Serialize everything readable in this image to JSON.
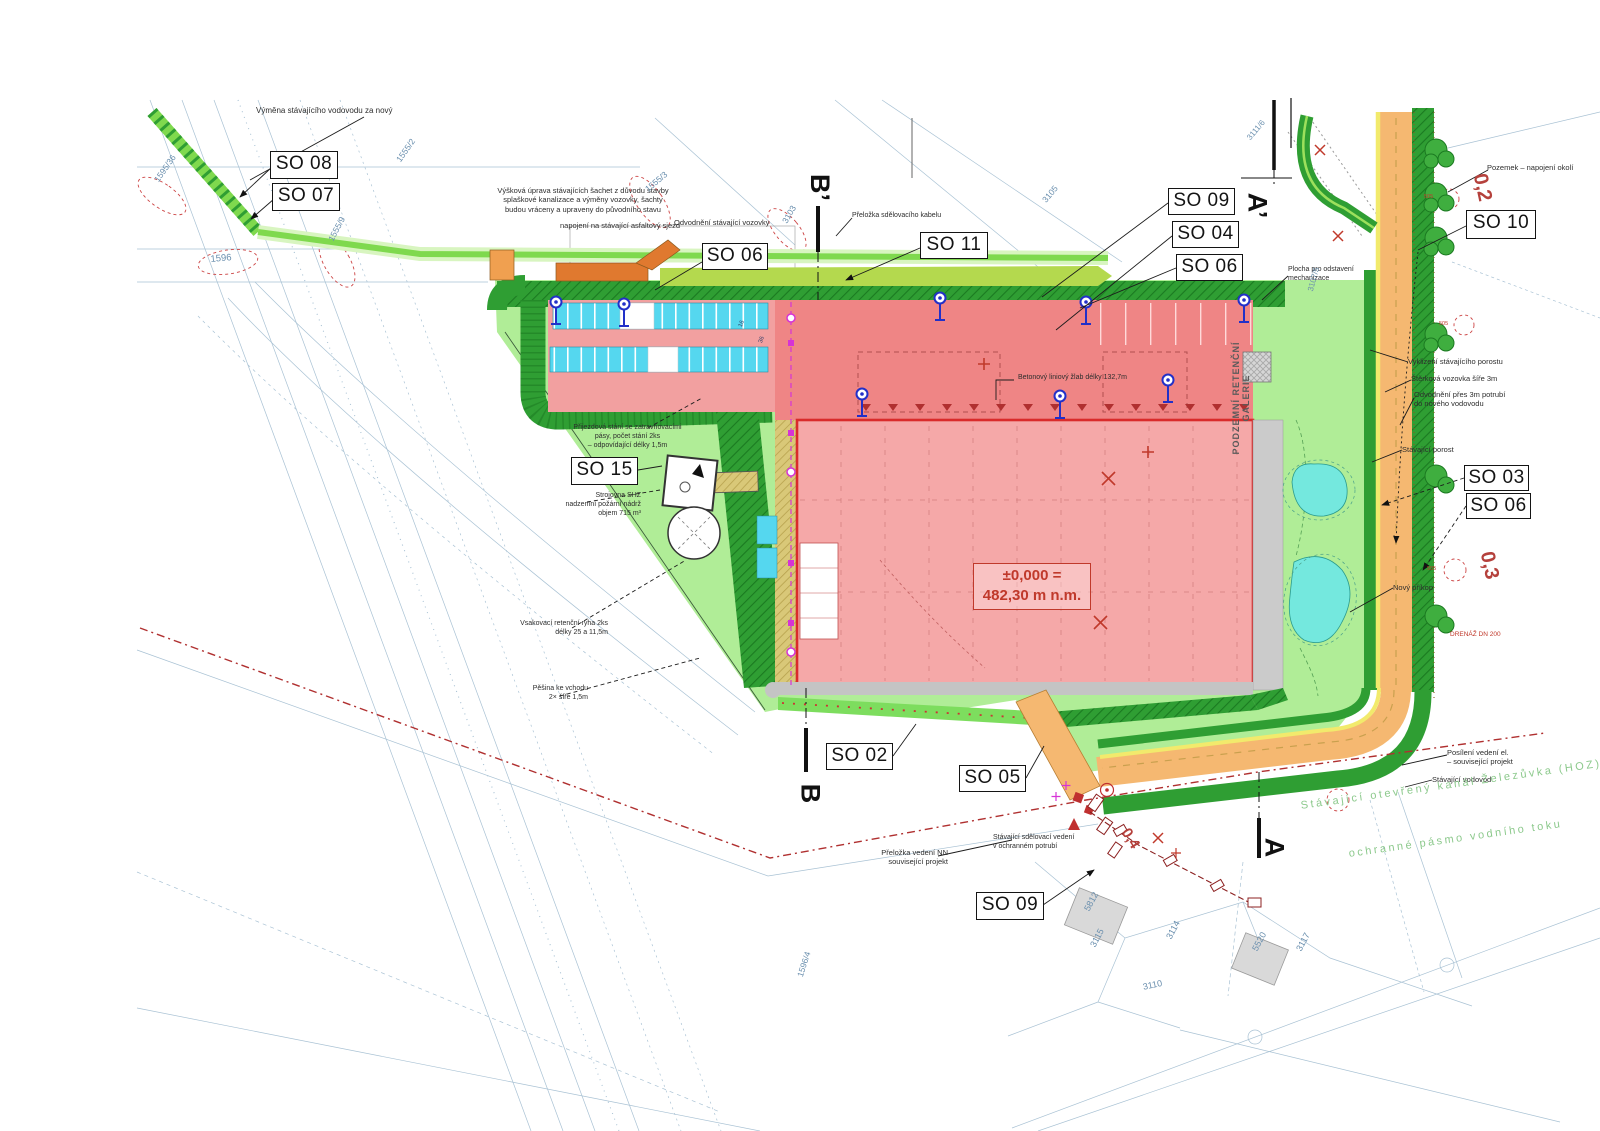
{
  "elevation": {
    "line1": "±0,000 =",
    "line2": "482,30 m n.m."
  },
  "building_text": "PODZEMNÍ RETENČNÍ GALERIE",
  "colors": {
    "lawn": "#b0ed97",
    "green_belt": "#2f9e33",
    "green_hatch": "#1b7a21",
    "road_orange": "#f5b871",
    "edge_yellow": "#f2ea6c",
    "parking_cyan": "#55d7ef",
    "pond_cyan": "#74e8de",
    "building_pink": "#f5a8a8",
    "dock_pink": "#ef8585",
    "outline_red": "#d92b2b",
    "utility_red": "#b03030",
    "magenta": "#d633d6",
    "hydrant_blue": "#2230c8",
    "parcel_blue": "#6a8fae"
  },
  "so_labels": [
    {
      "id": "so-08",
      "text": "SO 08",
      "x": 270,
      "y": 151,
      "w": 68,
      "h": 28
    },
    {
      "id": "so-07",
      "text": "SO 07",
      "x": 272,
      "y": 183,
      "w": 68,
      "h": 28
    },
    {
      "id": "so-06a",
      "text": "SO 06",
      "x": 702,
      "y": 243,
      "w": 66,
      "h": 27
    },
    {
      "id": "so-11",
      "text": "SO 11",
      "x": 920,
      "y": 232,
      "w": 68,
      "h": 27
    },
    {
      "id": "so-09a",
      "text": "SO 09",
      "x": 1168,
      "y": 188,
      "w": 67,
      "h": 27
    },
    {
      "id": "so-04",
      "text": "SO 04",
      "x": 1172,
      "y": 221,
      "w": 67,
      "h": 27
    },
    {
      "id": "so-06b",
      "text": "SO 06",
      "x": 1176,
      "y": 254,
      "w": 67,
      "h": 27
    },
    {
      "id": "so-10",
      "text": "SO 10",
      "x": 1466,
      "y": 210,
      "w": 70,
      "h": 29
    },
    {
      "id": "so-03",
      "text": "SO 03",
      "x": 1464,
      "y": 465,
      "w": 65,
      "h": 26
    },
    {
      "id": "so-06c",
      "text": "SO 06",
      "x": 1466,
      "y": 493,
      "w": 65,
      "h": 26
    },
    {
      "id": "so-15",
      "text": "SO 15",
      "x": 571,
      "y": 457,
      "w": 67,
      "h": 28
    },
    {
      "id": "so-02",
      "text": "SO 02",
      "x": 826,
      "y": 743,
      "w": 67,
      "h": 27
    },
    {
      "id": "so-05",
      "text": "SO 05",
      "x": 959,
      "y": 765,
      "w": 67,
      "h": 27
    },
    {
      "id": "so-09b",
      "text": "SO 09",
      "x": 976,
      "y": 892,
      "w": 68,
      "h": 28
    }
  ],
  "section_markers": [
    {
      "id": "b-prime",
      "text": "B’",
      "x": 806,
      "y": 172
    },
    {
      "id": "b",
      "text": "B",
      "x": 800,
      "y": 778
    },
    {
      "id": "a-prime",
      "text": "A’",
      "x": 1244,
      "y": 190
    },
    {
      "id": "a",
      "text": "A",
      "x": 1264,
      "y": 832
    }
  ],
  "red_notes": [
    {
      "text": "0,2",
      "x": 1468,
      "y": 176,
      "rot": 78,
      "size": 20
    },
    {
      "text": "0,3",
      "x": 1475,
      "y": 554,
      "rot": 78,
      "size": 20
    },
    {
      "text": "0,4",
      "x": 1120,
      "y": 830,
      "rot": 58,
      "size": 15
    }
  ],
  "annotations": [
    {
      "x": 256,
      "y": 106,
      "size": 8,
      "lines": [
        "Výměna stávajícího vodovodu za nový"
      ]
    },
    {
      "x": 478,
      "y": 186,
      "size": 7.5,
      "w": 210,
      "align": "center",
      "lines": [
        "Výšková úprava stávajících šachet z důvodu stavby",
        "splaškové kanalizace a výměny vozovky, šachty",
        "budou vráceny a upraveny do původního stavu"
      ]
    },
    {
      "x": 560,
      "y": 221,
      "size": 7.5,
      "lines": [
        "napojení na stávající asfaltový sjezd"
      ]
    },
    {
      "x": 674,
      "y": 218,
      "size": 7.5,
      "lines": [
        "Odvodnění stávající vozovky"
      ]
    },
    {
      "x": 852,
      "y": 212,
      "size": 7,
      "lines": [
        "Přeložka sdělovacího kabelu"
      ]
    },
    {
      "x": 1487,
      "y": 163,
      "size": 7.5,
      "lines": [
        "Pozemek – napojení okolí"
      ]
    },
    {
      "x": 1288,
      "y": 266,
      "size": 7,
      "lines": [
        "Plocha pro odstavení",
        "mechanizace"
      ]
    },
    {
      "x": 1408,
      "y": 357,
      "size": 7.5,
      "lines": [
        "Vyklizení stávajícího porostu"
      ]
    },
    {
      "x": 1411,
      "y": 374,
      "size": 7.5,
      "lines": [
        "Štěrková vozovka šíře 3m"
      ]
    },
    {
      "x": 1414,
      "y": 390,
      "size": 7.5,
      "lines": [
        "Odvodnění přes 3m potrubí",
        "do nového vodovodu"
      ]
    },
    {
      "x": 1402,
      "y": 445,
      "size": 7.5,
      "lines": [
        "Stávající porost"
      ]
    },
    {
      "x": 1393,
      "y": 583,
      "size": 7.5,
      "lines": [
        "Nový příkop"
      ]
    },
    {
      "x": 1450,
      "y": 631,
      "size": 6.5,
      "color": "#c0392b",
      "lines": [
        "DRENÁŽ DN 200"
      ]
    },
    {
      "x": 864,
      "y": 848,
      "size": 7.5,
      "w": 84,
      "align": "right",
      "lines": [
        "Přeložka vedení NN",
        "související projekt"
      ]
    },
    {
      "x": 993,
      "y": 834,
      "size": 7,
      "lines": [
        "Stávající sdělovací vedení",
        "v ochranném potrubí"
      ]
    },
    {
      "x": 1447,
      "y": 748,
      "size": 7.5,
      "lines": [
        "Posílení vedení el.",
        "– související projekt"
      ]
    },
    {
      "x": 1432,
      "y": 775,
      "size": 7.5,
      "lines": [
        "Stávající vodovod"
      ]
    },
    {
      "x": 545,
      "y": 492,
      "size": 7,
      "w": 96,
      "align": "right",
      "lines": [
        "Strojovna SHZ",
        "nadzemní požární nádrž",
        "objem 715 m³"
      ]
    },
    {
      "x": 468,
      "y": 620,
      "size": 7,
      "w": 140,
      "align": "right",
      "lines": [
        "Vsakovací retenční rýha 2ks",
        "délky 25 a 11,5m"
      ]
    },
    {
      "x": 468,
      "y": 685,
      "size": 7,
      "w": 120,
      "align": "right",
      "lines": [
        "Pěšina ke vchodu",
        "2× šíře 1,5m"
      ]
    },
    {
      "x": 540,
      "y": 424,
      "size": 7,
      "w": 175,
      "align": "center",
      "lines": [
        "Přijezdová stání se zatravňovacími",
        "pásy, počet stání 2ks",
        "– odpovídající délky 1,5m"
      ]
    },
    {
      "x": 1018,
      "y": 374,
      "size": 7,
      "lines": [
        "Betonový liniový žlab délky 132,7m"
      ]
    },
    {
      "x": 1424,
      "y": 194,
      "size": 5.5,
      "color": "#c0392b",
      "lines": [
        "505"
      ]
    },
    {
      "x": 1439,
      "y": 321,
      "size": 5.5,
      "color": "#c0392b",
      "lines": [
        "505"
      ]
    },
    {
      "x": 1427,
      "y": 566,
      "size": 5.5,
      "color": "#c0392b",
      "lines": [
        "505"
      ]
    },
    {
      "x": 738,
      "y": 326,
      "size": 6,
      "rot": -70,
      "color": "#33406a",
      "lines": [
        "16"
      ]
    },
    {
      "x": 758,
      "y": 342,
      "size": 6,
      "rot": -70,
      "color": "#33406a",
      "lines": [
        "36"
      ]
    }
  ],
  "green_notes": [
    {
      "text": "Stávající otevřený kanál Železůvka (HOZ)",
      "x": 1300,
      "y": 800,
      "rot": -8
    },
    {
      "text": "ochranné pásmo vodního toku",
      "x": 1348,
      "y": 848,
      "rot": -8
    }
  ],
  "parcel_numbers": [
    {
      "text": "1595/36",
      "x": 152,
      "y": 178,
      "rot": -55,
      "size": 8.5
    },
    {
      "text": "1596",
      "x": 210,
      "y": 254,
      "rot": -5,
      "size": 9.5
    },
    {
      "text": "1555/9",
      "x": 326,
      "y": 238,
      "rot": -62,
      "size": 8.5
    },
    {
      "text": "1555/2",
      "x": 394,
      "y": 158,
      "rot": -55,
      "size": 8.5
    },
    {
      "text": "1555/3",
      "x": 643,
      "y": 186,
      "rot": -40,
      "size": 8.5
    },
    {
      "text": "3103",
      "x": 780,
      "y": 220,
      "rot": -60,
      "size": 8.5
    },
    {
      "text": "3105",
      "x": 1040,
      "y": 198,
      "rot": -50,
      "size": 8.5
    },
    {
      "text": "3111/6",
      "x": 1245,
      "y": 136,
      "rot": -50,
      "size": 8
    },
    {
      "text": "3107/5",
      "x": 1306,
      "y": 290,
      "rot": -75,
      "size": 8
    },
    {
      "text": "3115",
      "x": 1088,
      "y": 944,
      "rot": -62,
      "size": 9
    },
    {
      "text": "3114",
      "x": 1164,
      "y": 936,
      "rot": -62,
      "size": 9
    },
    {
      "text": "3110",
      "x": 1142,
      "y": 982,
      "rot": -12,
      "size": 9
    },
    {
      "text": "3117",
      "x": 1294,
      "y": 948,
      "rot": -62,
      "size": 9
    },
    {
      "text": "5812",
      "x": 1082,
      "y": 908,
      "rot": -62,
      "size": 9
    },
    {
      "text": "5520",
      "x": 1250,
      "y": 948,
      "rot": -62,
      "size": 9
    },
    {
      "text": "1596/4",
      "x": 795,
      "y": 975,
      "rot": -72,
      "size": 8.5
    }
  ]
}
